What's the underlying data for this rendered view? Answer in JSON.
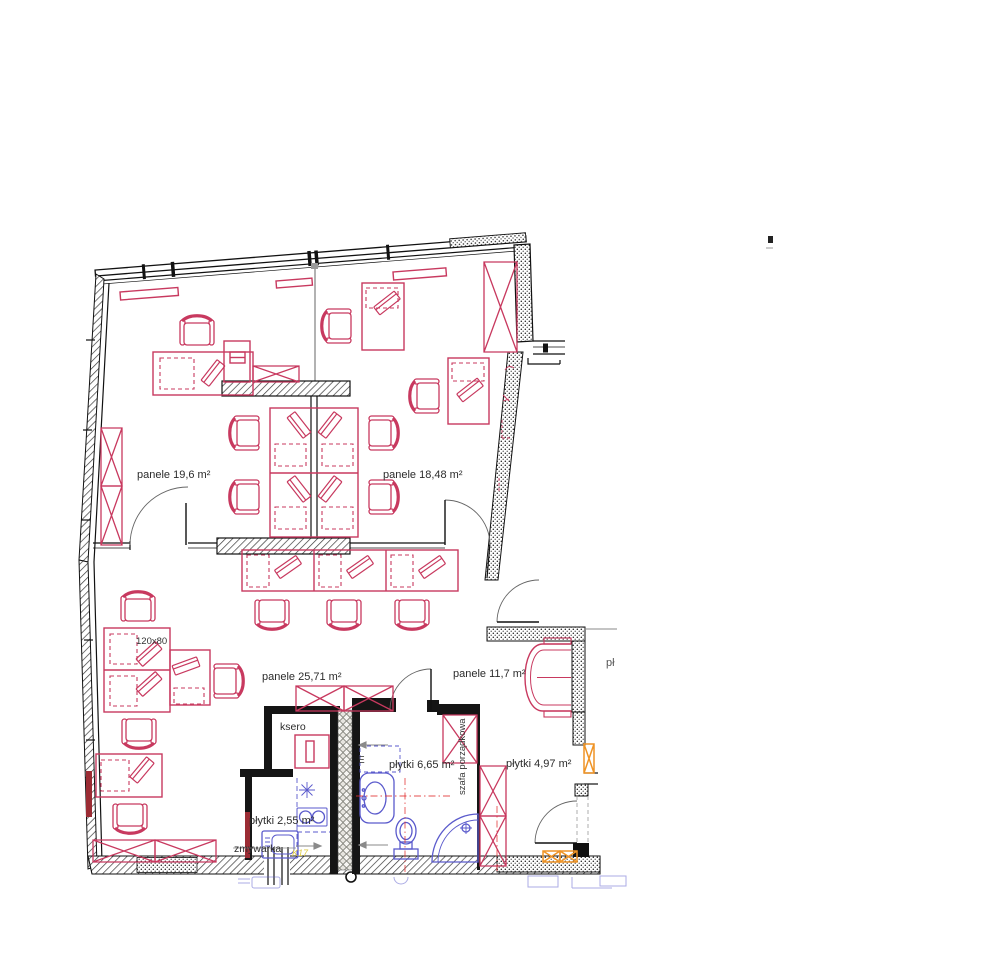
{
  "page": {
    "background": "#ffffff"
  },
  "plan": {
    "type": "architectural-floor-plan",
    "rooms": [
      {
        "id": "office-top-left",
        "flooring": "panele",
        "area_m2": "19,6",
        "label": "panele 19,6  m²"
      },
      {
        "id": "office-top-right",
        "flooring": "panele",
        "area_m2": "18,48",
        "label": "panele 18,48  m²"
      },
      {
        "id": "office-main",
        "flooring": "panele",
        "area_m2": "25,71",
        "label": "panele 25,71  m²"
      },
      {
        "id": "vestibule",
        "flooring": "panele",
        "area_m2": "11,7",
        "label": "panele 11,7  m²"
      },
      {
        "id": "bathroom",
        "flooring": "płytki",
        "area_m2": "6,65",
        "label": "płytki 6,65  m²"
      },
      {
        "id": "hall",
        "flooring": "płytki",
        "area_m2": "4,97",
        "label": "płytki 4,97  m²"
      },
      {
        "id": "kitchenette",
        "flooring": "płytki",
        "area_m2": "2,55",
        "label": "płytki 2,55  m²"
      }
    ],
    "annotations": {
      "desk_size": "120x80",
      "copier": "ksero",
      "dishwasher": "zmywarka",
      "cleaning_cabinet": "szafa porządkowa",
      "electrical_marker": "E",
      "truncated_label": "pł",
      "yellow_code": "K17"
    },
    "colors": {
      "furniture": "#c8395f",
      "sanitary": "#5a5acc",
      "accent": "#ef9426",
      "walls": "#111111",
      "text": "#2b2b2b",
      "yellow": "#ddc93f"
    }
  }
}
